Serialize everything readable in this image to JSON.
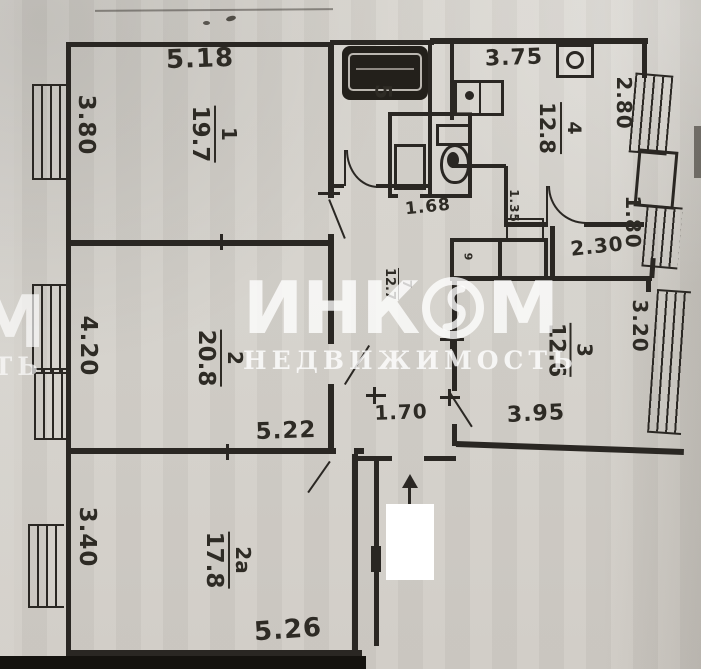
{
  "plan": {
    "rooms": {
      "living1": {
        "number": "1",
        "area": "19.7"
      },
      "living2": {
        "number": "2",
        "area": "20.8"
      },
      "living2a": {
        "number": "2а",
        "area": "17.8"
      },
      "room3": {
        "number": "3",
        "area": "12.6"
      },
      "kitchen": {
        "number": "4",
        "area": "12.8"
      },
      "bathroom": {
        "number": "5"
      },
      "corridor": {
        "number": "7",
        "area": "12.7"
      },
      "closet": {
        "number": "9"
      }
    },
    "dimensions": {
      "room1_top": "5.18",
      "room1_left": "3.80",
      "room2_left": "4.20",
      "room2_bottom": "5.22",
      "room2a_left": "3.40",
      "room2a_bottom": "5.26",
      "kitchen_top": "3.75",
      "kitchen_right_upper": "2.80",
      "kitchen_right_lower": "1.80",
      "passage_top": "2.30",
      "room3_bottom": "3.95",
      "room3_right": "3.20",
      "wc_bottom": "1.68",
      "corridor_nook": "1.35",
      "hall_bottom": "1.70"
    }
  },
  "watermark": {
    "brand_prefix": "ИНК",
    "brand_suffix": "М",
    "subtitle": "НЕДВИЖИМОСТЬ",
    "edge_fragment_big": "М",
    "edge_fragment_small": "ОСТЬ"
  },
  "colors": {
    "paper": "#d5d1cb",
    "ink": "#2a2723",
    "watermark": "#ffffff"
  }
}
